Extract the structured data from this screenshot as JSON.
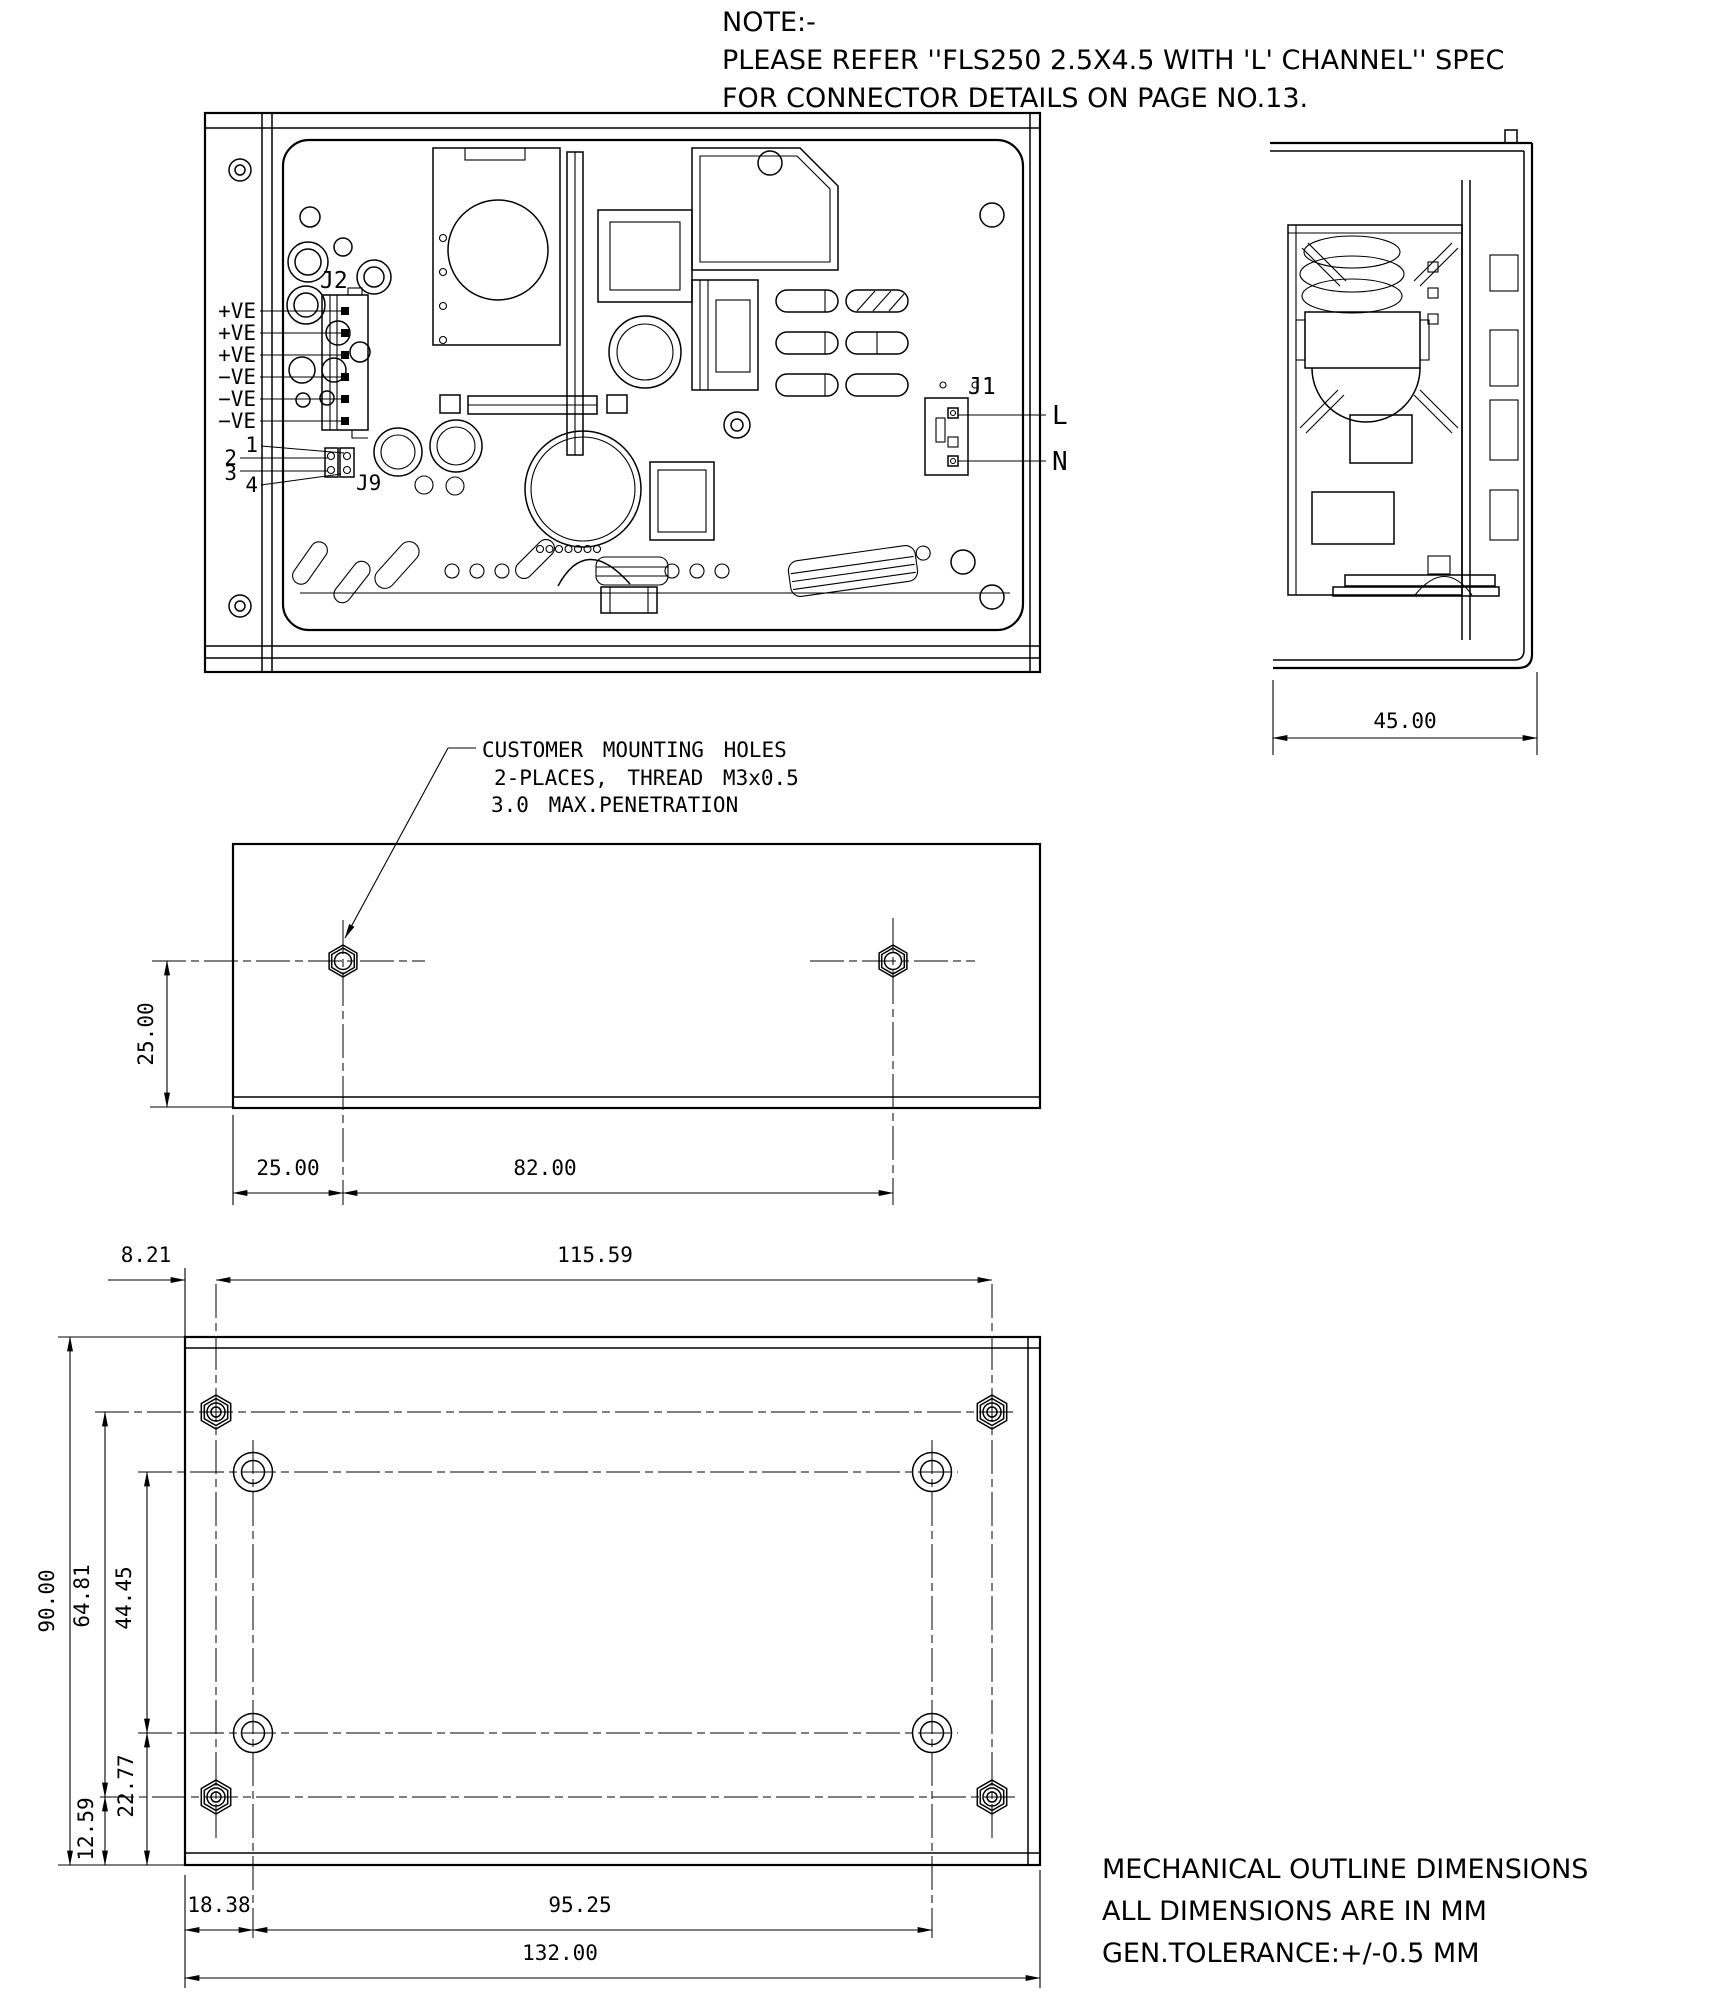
{
  "note": {
    "title": "NOTE:-",
    "line2": "PLEASE REFER ''FLS250 2.5X4.5 WITH 'L' CHANNEL'' SPEC",
    "line3": "FOR CONNECTOR DETAILS ON PAGE NO.13."
  },
  "top_view": {
    "j2_label": "J2",
    "pin_labels": [
      "+VE",
      "+VE",
      "+VE",
      "−VE",
      "−VE",
      "−VE"
    ],
    "pin_numbers": [
      "1",
      "2",
      "3",
      "4"
    ],
    "j9_label": "J9",
    "j1_label": "J1",
    "live_label": "L",
    "neutral_label": "N"
  },
  "side_view": {
    "depth_dim": "45.00"
  },
  "mounting_view": {
    "callout": [
      "CUSTOMER MOUNTING HOLES",
      "2-PLACES, THREAD M3x0.5",
      "3.0 MAX.PENETRATION"
    ],
    "edge_to_hole_dim": "25.00",
    "hole_offset_dim": "25.00",
    "hole_spacing_dim": "82.00"
  },
  "bottom_view": {
    "lip_dim": "8.21",
    "stud_spacing_h_dim": "115.59",
    "height_dim": "90.00",
    "stud_spacing_v_dim": "64.81",
    "hole_spacing_v_dim": "44.45",
    "hole_bottom_dim": "22.77",
    "stud_bottom_dim": "12.59",
    "hole_offset_h_dim": "18.38",
    "hole_spacing_h_dim": "95.25",
    "width_dim": "132.00"
  },
  "footer": [
    "MECHANICAL OUTLINE DIMENSIONS",
    "ALL DIMENSIONS ARE IN MM",
    "GEN.TOLERANCE:+/-0.5 MM"
  ],
  "colors": {
    "line": "#000000",
    "background": "#ffffff"
  }
}
